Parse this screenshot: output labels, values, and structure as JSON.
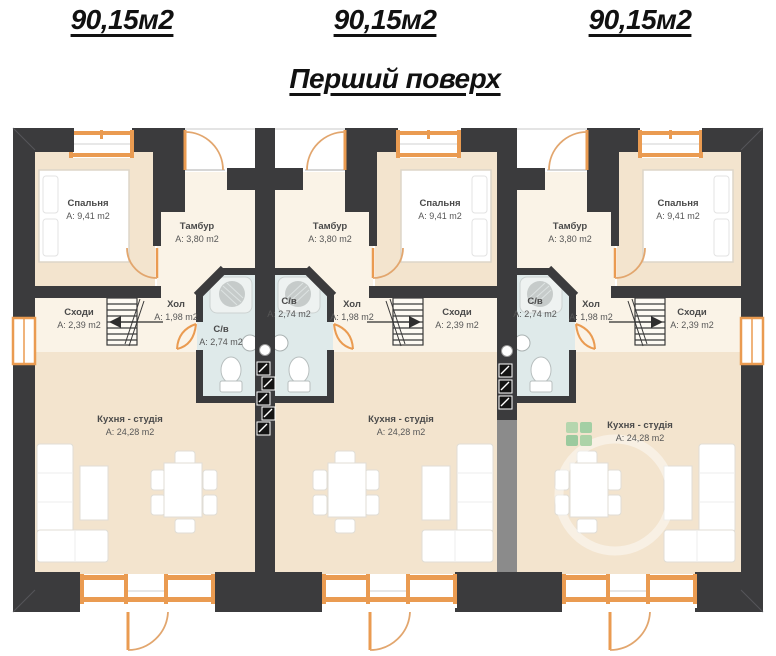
{
  "header": {
    "floor_title": "Перший поверх"
  },
  "units": [
    {
      "id": "unit-1",
      "area_label": "90,15м2",
      "rooms": {
        "bedroom": {
          "name": "Спальня",
          "area": "A: 9,41 m2"
        },
        "vestibule": {
          "name": "Тамбур",
          "area": "A: 3,80 m2"
        },
        "hall": {
          "name": "Хол",
          "area": "A: 1,98 m2"
        },
        "stairs": {
          "name": "Сходи",
          "area": "A: 2,39 m2"
        },
        "bathroom": {
          "name": "С/в",
          "area": "A: 2,74 m2"
        },
        "kitchen": {
          "name": "Кухня - студія",
          "area": "A: 24,28 m2"
        }
      }
    },
    {
      "id": "unit-2",
      "area_label": "90,15м2",
      "rooms": {
        "bedroom": {
          "name": "Спальня",
          "area": "A: 9,41 m2"
        },
        "vestibule": {
          "name": "Тамбур",
          "area": "A: 3,80 m2"
        },
        "hall": {
          "name": "Хол",
          "area": "A: 1,98 m2"
        },
        "stairs": {
          "name": "Сходи",
          "area": "A: 2,39 m2"
        },
        "bathroom": {
          "name": "С/в",
          "area": "A: 2,74 m2"
        },
        "kitchen": {
          "name": "Кухня - студія",
          "area": "A: 24,28 m2"
        }
      }
    },
    {
      "id": "unit-3",
      "area_label": "90,15м2",
      "rooms": {
        "bedroom": {
          "name": "Спальня",
          "area": "A: 9,41 m2"
        },
        "vestibule": {
          "name": "Тамбур",
          "area": "A: 3,80 m2"
        },
        "hall": {
          "name": "Хол",
          "area": "A: 1,98 m2"
        },
        "stairs": {
          "name": "Сходи",
          "area": "A: 2,39 m2"
        },
        "bathroom": {
          "name": "С/в",
          "area": "A: 2,74 m2"
        },
        "kitchen": {
          "name": "Кухня - студія",
          "area": "A: 24,28 m2"
        }
      }
    }
  ],
  "icons": {
    "builder_logo": "green-squares-watermark"
  },
  "colors": {
    "walls": "#3b3b3d",
    "walls_secondary": "#8b8b8b",
    "floor_warm": "#f3e4ce",
    "floor_light": "#faf3e7",
    "bathroom_floor": "#dfeaea",
    "joinery_orange": "#ea9b51",
    "logo_green": "#a3cfa4",
    "text": "#111111"
  }
}
